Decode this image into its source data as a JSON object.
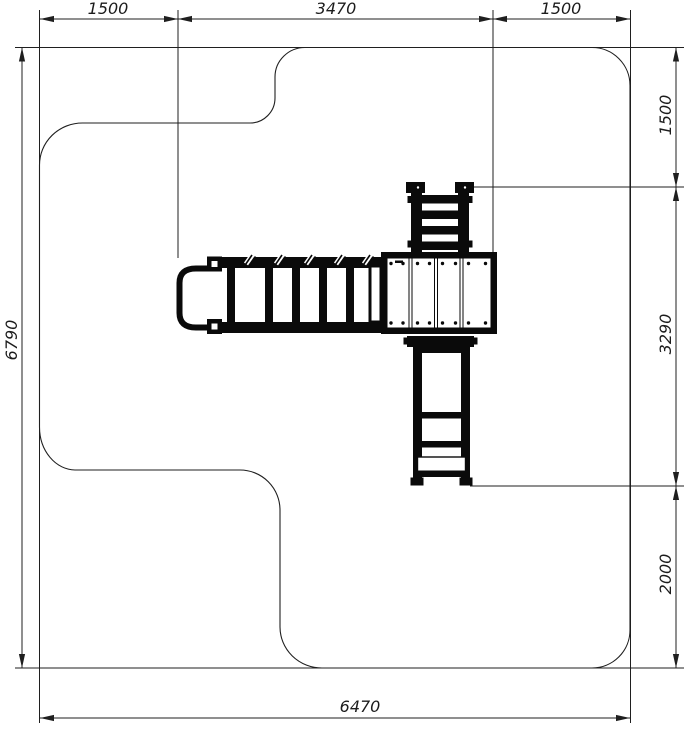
{
  "drawing": {
    "background_color": "#ffffff",
    "line_color": "#1f1f1f",
    "equipment_color": "#0a0a0a",
    "dims": {
      "top_left": "1500",
      "top_center": "3470",
      "top_right": "1500",
      "left_total": "6790",
      "right_top": "1500",
      "right_middle": "3290",
      "right_bottom": "2000",
      "bottom_total": "6470"
    }
  }
}
